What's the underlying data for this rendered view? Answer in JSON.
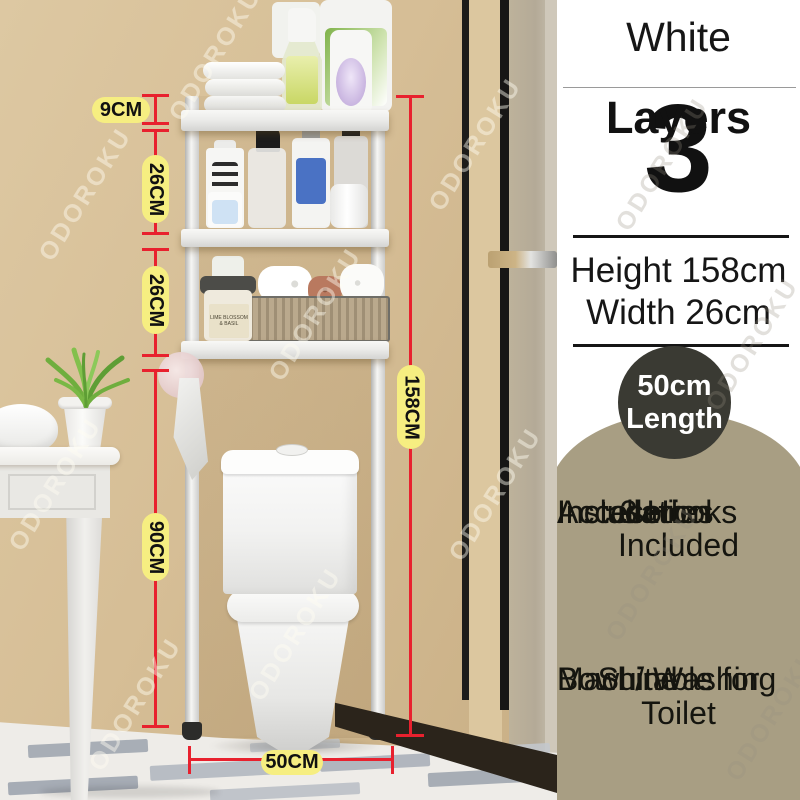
{
  "watermark": {
    "text": "ODOROKU"
  },
  "panel": {
    "title": "White",
    "layers": {
      "number": "3",
      "label": "Layers"
    },
    "dimensions": {
      "height": "Height 158cm",
      "width": "Width 26cm"
    },
    "length_badge": {
      "value": "50cm",
      "label": "Length"
    },
    "features": {
      "line1": "3 Hooks Included",
      "line2": "Installation",
      "line3": "Accesories",
      "line4": "Included"
    },
    "suitability": {
      "line1": "Suitable for Toilet",
      "line2": "Bowl / Washing",
      "line3": "Machine"
    }
  },
  "measurements": {
    "top_offset": "9CM",
    "tier_gap_upper": "26CM",
    "tier_gap_lower": "26CM",
    "clearance_height": "90CM",
    "total_height": "158CM",
    "base_width": "50CM"
  },
  "products": {
    "jar_label": "LIME BLOSSOM & BASIL"
  },
  "colors": {
    "accent_red": "#e8212e",
    "label_yellow": "#f6ee81",
    "wall_tan": "#d6be96",
    "blob_tan": "#a89e83",
    "badge_charcoal": "#3a3a33"
  }
}
